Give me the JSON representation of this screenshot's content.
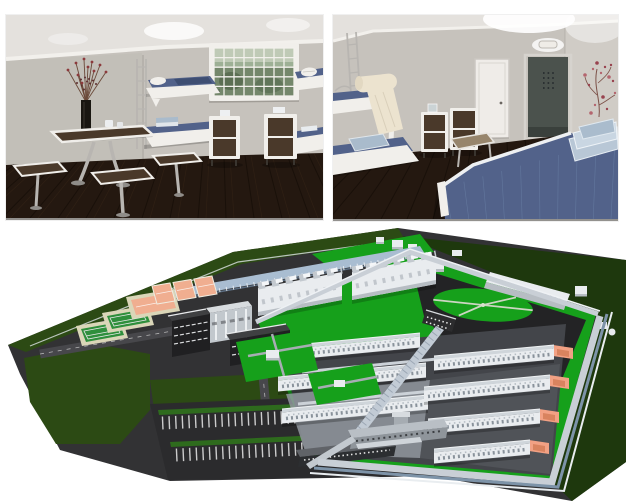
{
  "collage": {
    "background": "#ffffff",
    "photos": [
      {
        "id": "cell-interior-render-left",
        "type": "interior-3d-render",
        "features": [
          "wall-mounted-bunk-beds-blue-bedding",
          "dining-table-with-stools",
          "barred-glass-block-window",
          "two-storage-cabinets",
          "black-vase-with-red-branches",
          "ceiling-lights",
          "dark-wood-floor"
        ]
      },
      {
        "id": "cell-interior-render-right",
        "type": "interior-3d-render",
        "features": [
          "bunk-bed-with-rolled-towel",
          "chrome-ladder",
          "storage-cabinets",
          "white-interior-door",
          "dark-metal-door",
          "wall-sconce",
          "blue-denim-bed",
          "stack-of-folded-blankets",
          "wooden-bench",
          "branch-wall-decal",
          "dark-wood-floor"
        ]
      },
      {
        "id": "prison-campus-aerial-render",
        "type": "aerial-3d-render",
        "features": [
          "triangular-walled-site",
          "perimeter-walls",
          "rows-of-white-cell-blocks",
          "orange-roofed-annexes",
          "central-spine-corridor",
          "exercise-yard-with-circular-lawn",
          "sawtooth-roof-workshops",
          "sports-courts-green-and-salmon",
          "covered-blue-walkway",
          "striped-parking-lot",
          "gatehouse",
          "dark-green-outer-lawns",
          "bright-green-inner-lawns"
        ]
      }
    ]
  },
  "colors": {
    "bg": "#ffffff",
    "wall": "#c6c2bc",
    "wall2": "#b3afa9",
    "wallr": "#d0ccc6",
    "ceil": "#e4e1dd",
    "cornice": "#f2f0ec",
    "floor": "#241810",
    "plank": "#120b06",
    "floorlight": "#3d2a1a",
    "white": "#f1efeb",
    "denim": "#52628a",
    "denim2": "#3e4e72",
    "lightblue": "#a9bbcc",
    "cream": "#ece3cf",
    "wood": "#4a392a",
    "chrome": "#b8b5b1",
    "vase": "#191611",
    "twig": "#6b4a3a",
    "twigdot": "#8c3a3c",
    "doorw": "#efece8",
    "doord": "#4b524d",
    "decal": "#98424e",
    "asphalt": "#323234",
    "yard": "#232325",
    "road": "#47474b",
    "dgreen": "#2c4a14",
    "dgreen2": "#1e380d",
    "bgreen": "#16a01b",
    "courtframe": "#dad6b8",
    "courtgreen": "#2f8f3c",
    "courtsalmon": "#f0ae90",
    "wallband": "#c9cfd6",
    "blueband": "#7d93a8",
    "bwhite": "#e9ecef",
    "bshadow": "#b7bdc3",
    "roofg": "#cfd5da",
    "orange": "#f2a184",
    "oranged": "#d9835f",
    "darkb": "#212123",
    "pad": "#43454a",
    "concrete2": "#90979d",
    "walkway": "#a9bdd1",
    "walkway2": "#c2cbd5",
    "gate": "#8f959b",
    "gate2": "#b9bfc5",
    "windot": "#89929b"
  }
}
